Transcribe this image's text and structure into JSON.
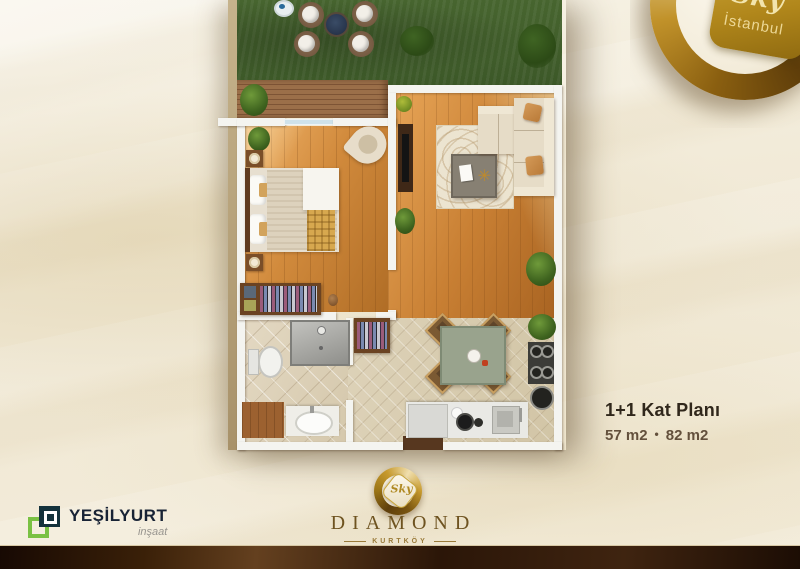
{
  "badge": {
    "script": "Sky",
    "city": "İstanbul"
  },
  "caption": {
    "title": "1+1 Kat Planı",
    "area_left": "57 m2",
    "separator": "•",
    "area_right": "82 m2"
  },
  "builder_logo": {
    "name": "YEŞİLYURT",
    "subtitle": "inşaat"
  },
  "project_logo": {
    "mark_script": "Sky",
    "name": "DIAMOND",
    "location": "KURTKÖY"
  },
  "icons": {
    "starburst": "✳"
  },
  "colors": {
    "background_cream": "#f2ecdb",
    "footer_band_brown": "#3a2008",
    "gold": "#b1871b",
    "grass_green": "#42602c",
    "wood_floor": "#c87f33",
    "wall_white": "#f4f4f0",
    "builder_green": "#7ac143",
    "builder_dark": "#14323c",
    "caption_title": "#30271b",
    "caption_area": "#63503c"
  },
  "floorplan": {
    "rooms": [
      "garden",
      "terrace-deck",
      "bedroom",
      "living-room",
      "bathroom",
      "hallway",
      "kitchen-dining"
    ]
  }
}
